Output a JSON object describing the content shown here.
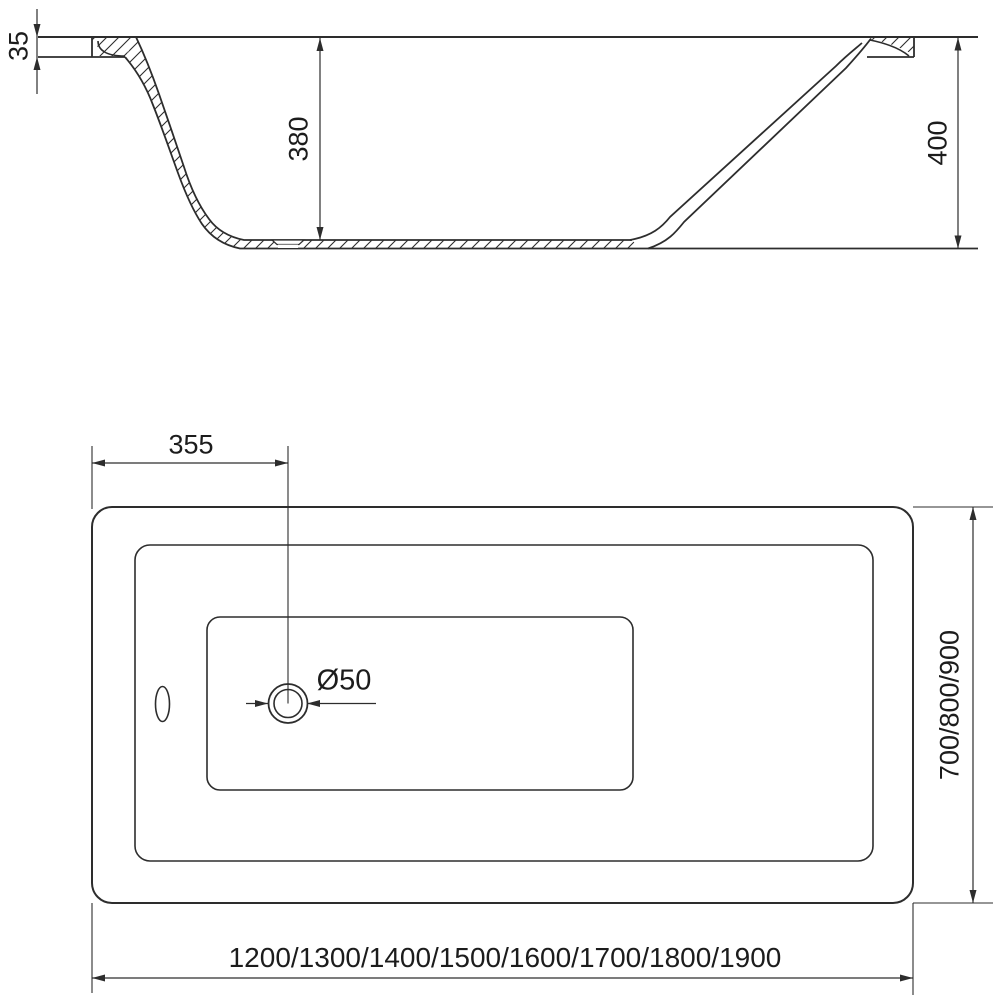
{
  "drawing": {
    "kind": "technical-drawing",
    "subject": "rectangular bathtub, side section view and top plan view",
    "line_color": "#2d2d2d",
    "background_color": "#ffffff",
    "text_color": "#1c1c1c"
  },
  "side_view": {
    "rim_thickness_label": "35",
    "inner_depth_label": "380",
    "total_height_label": "400"
  },
  "plan_view": {
    "drain_offset_label": "355",
    "drain_diameter_label": "Ø50",
    "width_options_label": "700/800/900",
    "length_options_label": "1200/1300/1400/1500/1600/1700/1800/1900"
  }
}
